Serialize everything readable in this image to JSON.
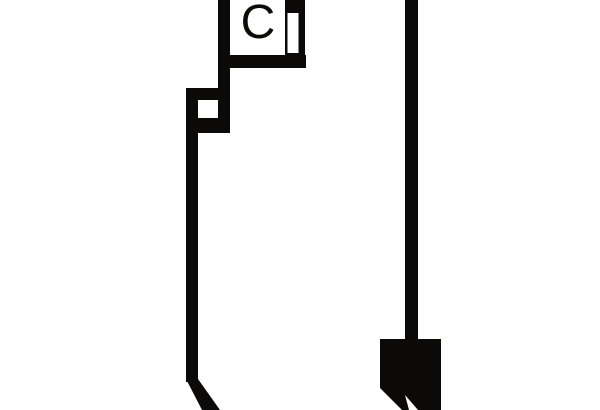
{
  "canvas": {
    "width": "600",
    "height": "410",
    "background": "#ffffff",
    "ink": "#0c0a08"
  },
  "figure": {
    "label": "C"
  }
}
